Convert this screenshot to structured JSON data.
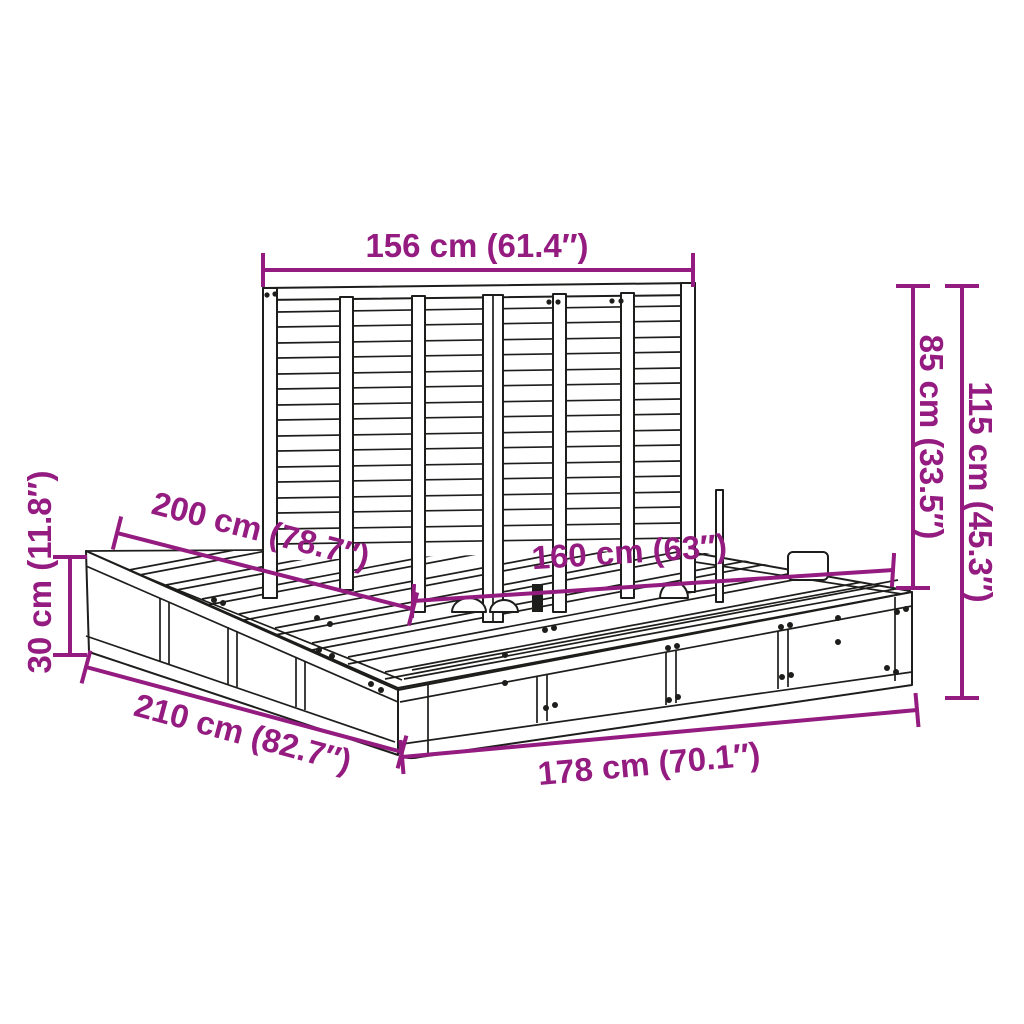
{
  "image": {
    "background": "#ffffff",
    "accent_color": "#941b80",
    "line_color": "#1d1d1b"
  },
  "dimensions": [
    {
      "id": "headboard-width",
      "label": "156 cm (61.4″)"
    },
    {
      "id": "headboard-height",
      "label": "85 cm (33.5″)"
    },
    {
      "id": "total-height",
      "label": "115 cm (45.3″)"
    },
    {
      "id": "frame-length-top",
      "label": "200 cm (78.7″)"
    },
    {
      "id": "frame-width-inner",
      "label": "160 cm (63″)"
    },
    {
      "id": "base-height",
      "label": "30 cm (11.8″)"
    },
    {
      "id": "frame-length-bottom",
      "label": "210 cm (82.7″)"
    },
    {
      "id": "frame-width-bottom",
      "label": "178 cm (70.1″)"
    }
  ]
}
